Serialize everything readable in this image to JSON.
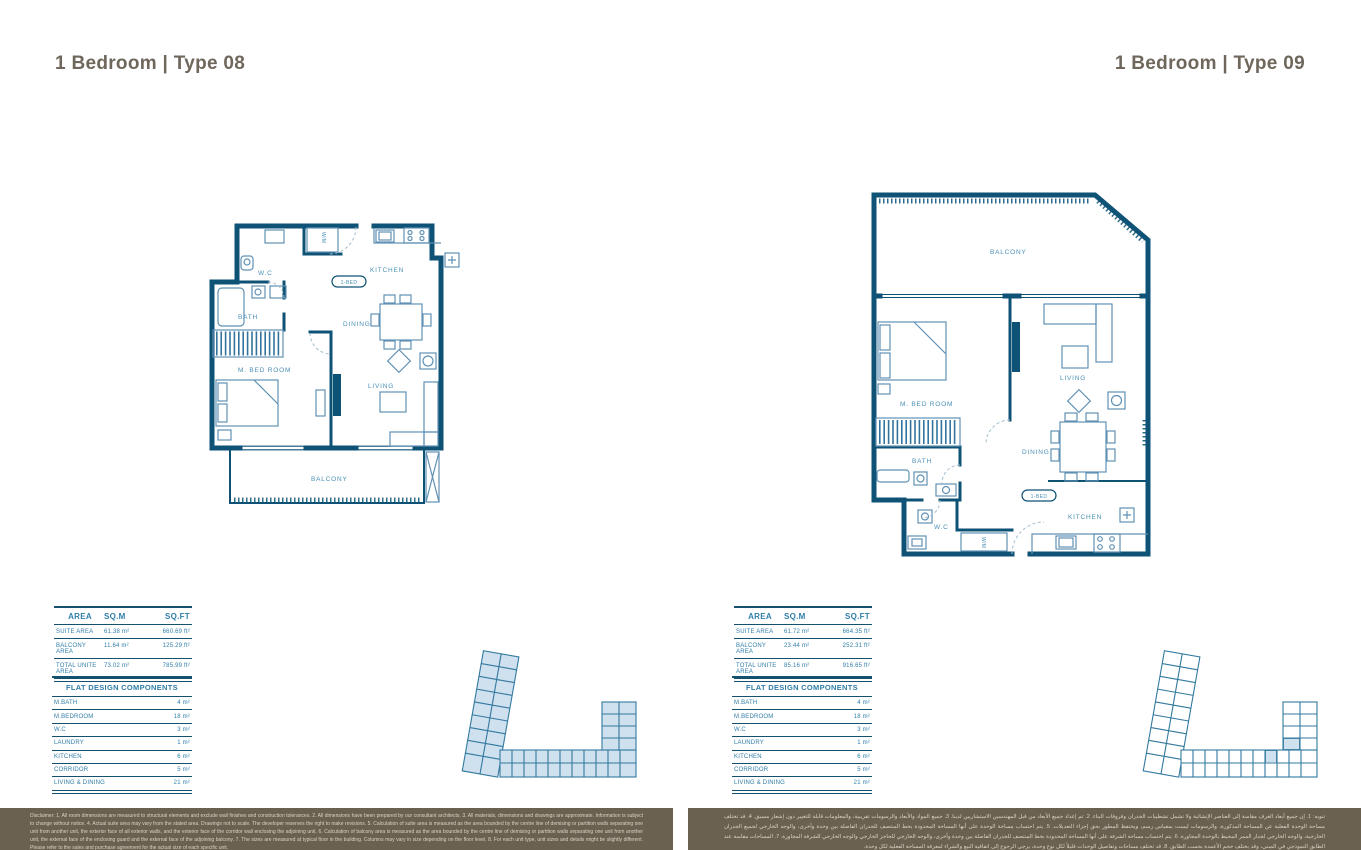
{
  "colors": {
    "wall": "#0e5276",
    "label": "#4a90b6",
    "table_border": "#14516f",
    "table_text": "#2f7ea8",
    "title": "#6f675c",
    "bar_bg": "#6b6150",
    "highlight": "#cfe0ee"
  },
  "left": {
    "title": "1 Bedroom | Type 08",
    "area_table": {
      "headers": [
        "AREA",
        "SQ.M",
        "SQ.FT"
      ],
      "rows": [
        [
          "SUITE AREA",
          "61.38 m²",
          "660.69 ft²"
        ],
        [
          "BALCONY AREA",
          "11.64 m²",
          "125.29 ft²"
        ],
        [
          "TOTAL UNITE AREA",
          "73.02 m²",
          "785.99 ft²"
        ]
      ]
    },
    "components_table": {
      "title": "FLAT DESIGN COMPONENTS",
      "rows": [
        [
          "M.BATH",
          "4 m²"
        ],
        [
          "M.BEDROOM",
          "18 m²"
        ],
        [
          "W.C",
          "3 m²"
        ],
        [
          "LAUNDRY",
          "1 m²"
        ],
        [
          "KITCHEN",
          "6 m²"
        ],
        [
          "CORRIDOR",
          "5 m²"
        ],
        [
          "LIVING & DINING",
          "21 m²"
        ]
      ]
    },
    "plan": {
      "wc": "W.C",
      "bath": "BATH",
      "master": "M. BED ROOM",
      "bed_tag": "1-BED",
      "kitchen": "KITCHEN",
      "dining": "DINING",
      "living": "LIVING",
      "balcony": "BALCONY",
      "wm": "W/M"
    }
  },
  "right": {
    "title": "1 Bedroom | Type 09",
    "area_table": {
      "headers": [
        "AREA",
        "SQ.M",
        "SQ.FT"
      ],
      "rows": [
        [
          "SUITE AREA",
          "61.72 m²",
          "664.35 ft²"
        ],
        [
          "BALCONY AREA",
          "23.44 m²",
          "252.31 ft²"
        ],
        [
          "TOTAL UNITE AREA",
          "85.16 m²",
          "916.65 ft²"
        ]
      ]
    },
    "components_table": {
      "title": "FLAT DESIGN COMPONENTS",
      "rows": [
        [
          "M.BATH",
          "4 m²"
        ],
        [
          "M.BEDROOM",
          "18 m²"
        ],
        [
          "W.C",
          "3 m²"
        ],
        [
          "LAUNDRY",
          "1 m²"
        ],
        [
          "KITCHEN",
          "6 m²"
        ],
        [
          "CORRIDOR",
          "5 m²"
        ],
        [
          "LIVING & DINING",
          "21 m²"
        ]
      ]
    },
    "plan": {
      "wc": "W.C",
      "bath": "BATH",
      "master": "M. BED ROOM",
      "bed_tag": "1-BED",
      "kitchen": "KITCHEN",
      "dining": "DINING",
      "living": "LIVING",
      "balcony": "BALCONY",
      "wm": "W/M"
    }
  },
  "disclaimer_en": "Disclaimer: 1. All room dimensions are measured to structural elements and exclude wall finishes and construction tolerances. 2. All dimensions have been prepared by our consultant architects. 3. All materials, dimensions and drawings are approximate. Information is subject to change without notice. 4. Actual suite area may vary from the stated area. Drawings not to scale. The developer reserves the right to make revisions. 5. Calculation of suite area is measured as the area bounded by the centre line of demising or partition walls separating one unit from another unit, the exterior face of all exterior walls, and the exterior face of the corridor wall enclosing the adjoining unit. 6. Calculation of balcony area is measured as the area bounded by the centre line of demising or partition walls separating one unit from another unit, the external face of the enclosing guard and the external face of the adjoining balcony. 7. The sizes are measured at typical floor in the building. Columns may vary in size depending on the floor level. 8. For each unit type, unit sizes and details might be slightly different. Please refer to the sales and purchase agreement for the actual size of each specific unit.",
  "disclaimer_ar": "تنويه: 1. إن جميع أبعاد الغرف مقاسة إلى العناصر الإنشائية ولا تشمل تشطيبات الجدران وفروقات البناء. 2. تم إعداد جميع الأبعاد من قبل المهندسين الاستشاريين لدينا. 3. جميع المواد والأبعاد والرسومات تقريبية، والمعلومات قابلة للتغيير دون إشعار مسبق. 4. قد تختلف مساحة الوحدة الفعلية عن المساحة المذكورة، والرسومات ليست بمقياس رسم، ويحتفظ المطور بحق إجراء التعديلات. 5. يتم احتساب مساحة الوحدة على أنها المساحة المحدودة بخط المنتصف للجدران الفاصلة بين وحدة وأخرى، والوجه الخارجي لجميع الجدران الخارجية، والوجه الخارجي لجدار الممر المحيط بالوحدة المجاورة. 6. يتم احتساب مساحة الشرفة على أنها المساحة المحدودة بخط المنتصف للجدران الفاصلة بين وحدة وأخرى، والوجه الخارجي للحاجز الخارجي والوجه الخارجي للشرفة المجاورة. 7. المساحات مقاسة عند الطابق النموذجي في المبنى، وقد يختلف حجم الأعمدة بحسب الطابق. 8. قد تختلف مساحات وتفاصيل الوحدات قليلاً لكل نوع وحدة، يرجى الرجوع إلى اتفاقية البيع والشراء لمعرفة المساحة الفعلية لكل وحدة."
}
